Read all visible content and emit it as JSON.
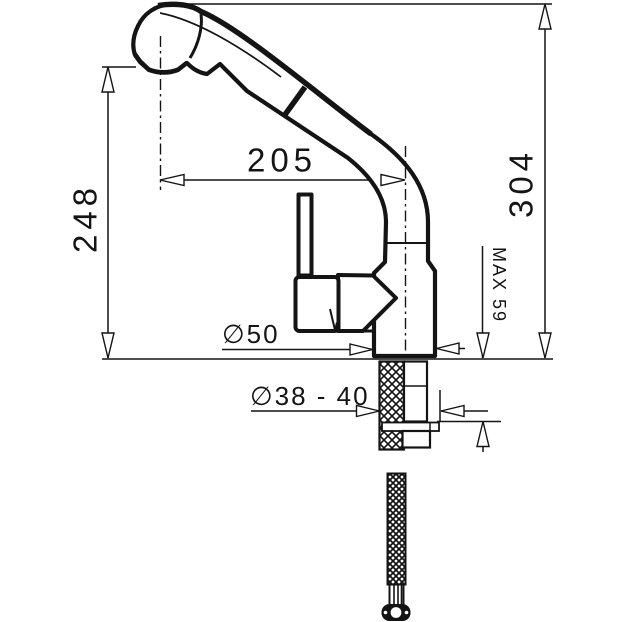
{
  "drawing": {
    "kind": "kitchen-faucet-dimension-drawing",
    "dims": {
      "reach": "205",
      "outlet_height": "248",
      "overall_height": "304",
      "max_counter_thickness": "MAX 59",
      "base_diameter": "∅50",
      "mounting_hole_diameter": "∅38 - 40"
    }
  },
  "style": {
    "ink": "#141414",
    "background": "#ffffff"
  }
}
